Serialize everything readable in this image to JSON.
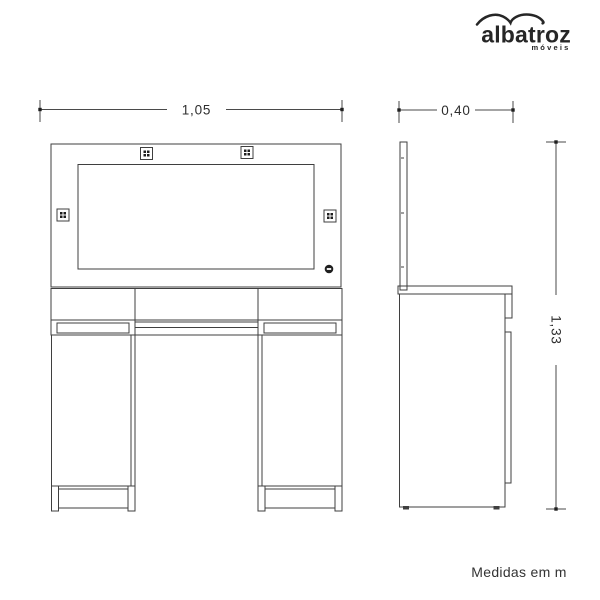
{
  "logo": {
    "brand": "albatroz",
    "tagline": "móveis",
    "icon": "albatross-swoosh-icon",
    "color": "#262626"
  },
  "dimensions": {
    "front_width_m": "1,05",
    "side_depth_m": "0,40",
    "height_m": "1,33"
  },
  "footer": {
    "note": "Medidas em m"
  },
  "colors": {
    "line": "#3f3f3f",
    "ink": "#262626",
    "background": "#ffffff"
  }
}
